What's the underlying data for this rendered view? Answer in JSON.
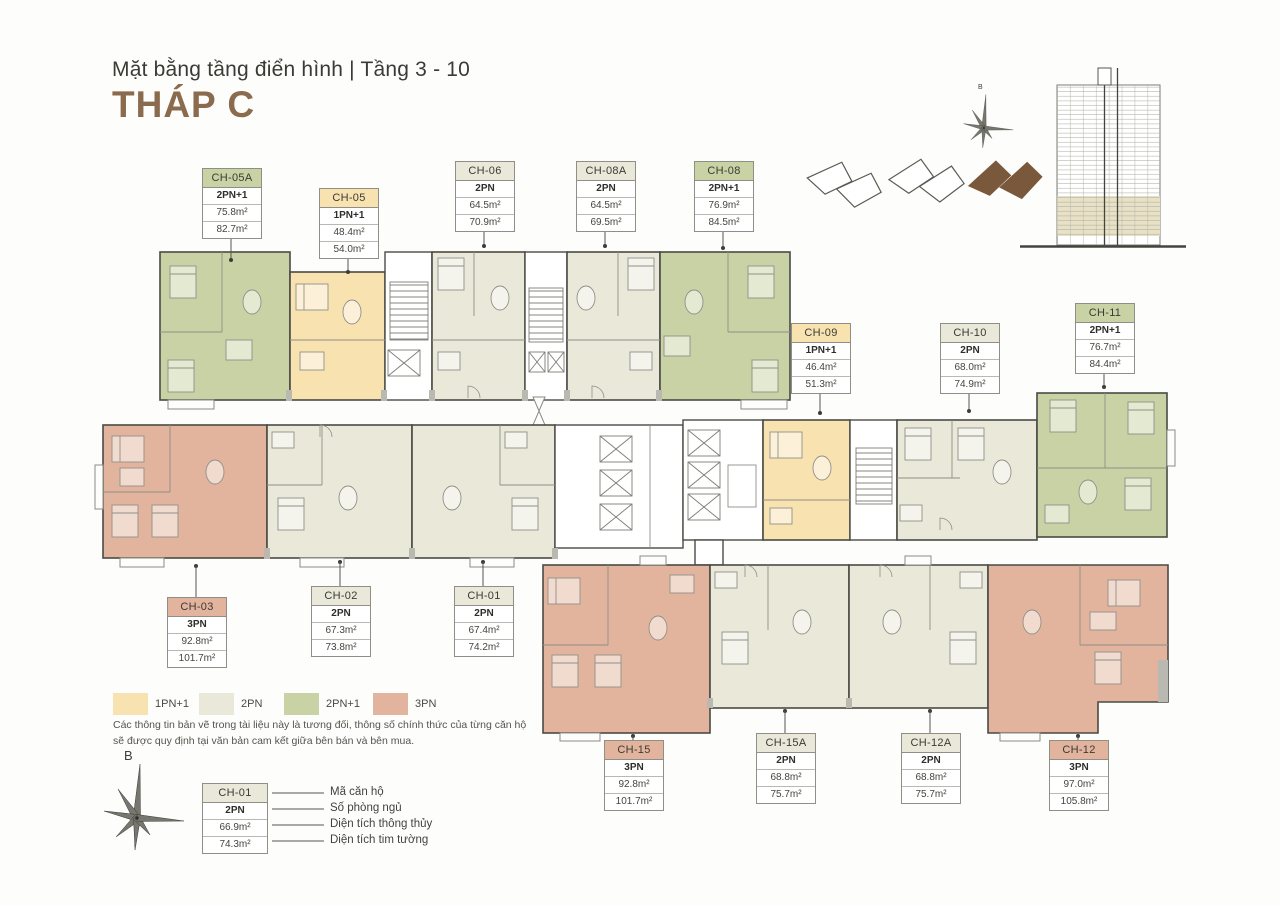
{
  "header": {
    "subtitle": "Mặt bằng tầng điển hình | Tầng 3 - 10",
    "title": "THÁP C"
  },
  "units": [
    {
      "code": "CH-05A",
      "type": "2PN+1",
      "area_net": "75.8m²",
      "area_gross": "82.7m²"
    },
    {
      "code": "CH-05",
      "type": "1PN+1",
      "area_net": "48.4m²",
      "area_gross": "54.0m²"
    },
    {
      "code": "CH-06",
      "type": "2PN",
      "area_net": "64.5m²",
      "area_gross": "70.9m²"
    },
    {
      "code": "CH-08A",
      "type": "2PN",
      "area_net": "64.5m²",
      "area_gross": "69.5m²"
    },
    {
      "code": "CH-08",
      "type": "2PN+1",
      "area_net": "76.9m²",
      "area_gross": "84.5m²"
    },
    {
      "code": "CH-09",
      "type": "1PN+1",
      "area_net": "46.4m²",
      "area_gross": "51.3m²"
    },
    {
      "code": "CH-10",
      "type": "2PN",
      "area_net": "68.0m²",
      "area_gross": "74.9m²"
    },
    {
      "code": "CH-11",
      "type": "2PN+1",
      "area_net": "76.7m²",
      "area_gross": "84.4m²"
    },
    {
      "code": "CH-03",
      "type": "3PN",
      "area_net": "92.8m²",
      "area_gross": "101.7m²"
    },
    {
      "code": "CH-02",
      "type": "2PN",
      "area_net": "67.3m²",
      "area_gross": "73.8m²"
    },
    {
      "code": "CH-01",
      "type": "2PN",
      "area_net": "67.4m²",
      "area_gross": "74.2m²"
    },
    {
      "code": "CH-15",
      "type": "3PN",
      "area_net": "92.8m²",
      "area_gross": "101.7m²"
    },
    {
      "code": "CH-15A",
      "type": "2PN",
      "area_net": "68.8m²",
      "area_gross": "75.7m²"
    },
    {
      "code": "CH-12A",
      "type": "2PN",
      "area_net": "68.8m²",
      "area_gross": "75.7m²"
    },
    {
      "code": "CH-12",
      "type": "3PN",
      "area_net": "97.0m²",
      "area_gross": "105.8m²"
    }
  ],
  "legend": {
    "items": [
      {
        "label": "1PN+1",
        "color": "#F8E3B0"
      },
      {
        "label": "2PN",
        "color": "#EAE8D8"
      },
      {
        "label": "2PN+1",
        "color": "#C9D2A5"
      },
      {
        "label": "3PN",
        "color": "#E3B49D"
      }
    ]
  },
  "disclaimer": {
    "line1": "Các thông tin bản vẽ trong tài liệu này là tương đối, thông số chính thức của từng căn hộ",
    "line2": "sẽ được quy định tại văn bản cam kết giữa bên bán và bên mua."
  },
  "sample_key": {
    "code": "CH-01",
    "type": "2PN",
    "area_net": "66.9m²",
    "area_gross": "74.3m²",
    "labels": {
      "code": "Mã căn hộ",
      "bedrooms": "Số phòng ngủ",
      "net": "Diện tích thông thủy",
      "gross": "Diện tích tim tường"
    }
  },
  "compass": {
    "north_label": "B"
  },
  "colors": {
    "title_brown": "#8B6B4E",
    "footprint_brown": "#7A583C",
    "elevation_highlight": "#E8E1C5"
  }
}
